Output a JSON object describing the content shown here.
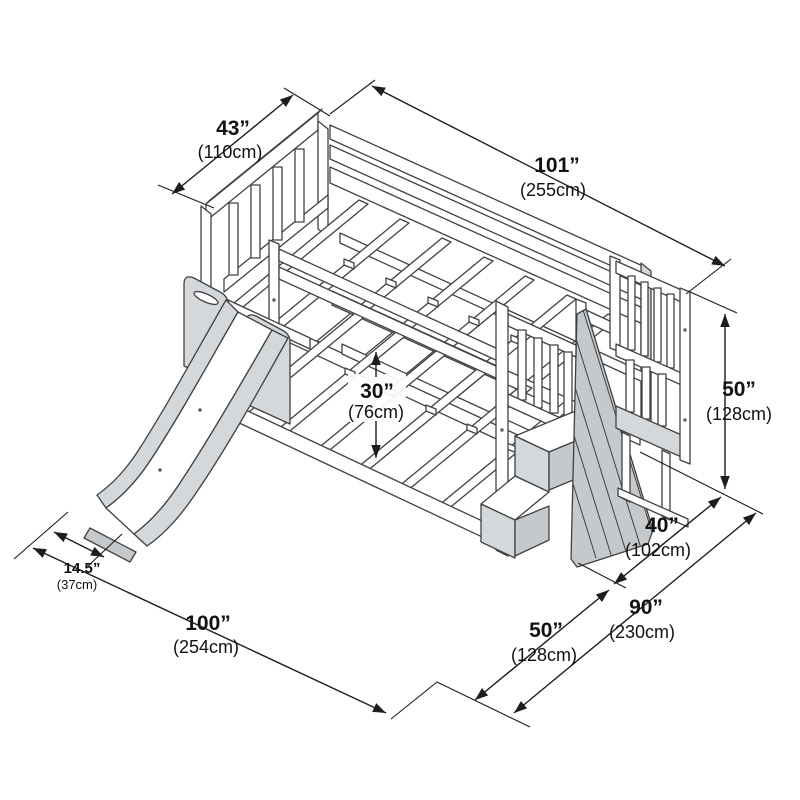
{
  "diagram": {
    "subject": "Bunk bed with slide and staircase — isometric dimension drawing",
    "background": "#ffffff",
    "line_color": "#3f4143",
    "text_color": "#111111"
  },
  "dims": {
    "d43": {
      "in": "43”",
      "cm": "(110cm)"
    },
    "d101": {
      "in": "101”",
      "cm": "(255cm)"
    },
    "d50r": {
      "in": "50”",
      "cm": "(128cm)"
    },
    "d30": {
      "in": "30”",
      "cm": "(76cm)"
    },
    "d40": {
      "in": "40”",
      "cm": "(102cm)"
    },
    "d90": {
      "in": "90”",
      "cm": "(230cm)"
    },
    "d50b": {
      "in": "50”",
      "cm": "(128cm)"
    },
    "d100": {
      "in": "100”",
      "cm": "(254cm)"
    },
    "d145": {
      "in": "14.5”",
      "cm": "(37cm)"
    }
  }
}
